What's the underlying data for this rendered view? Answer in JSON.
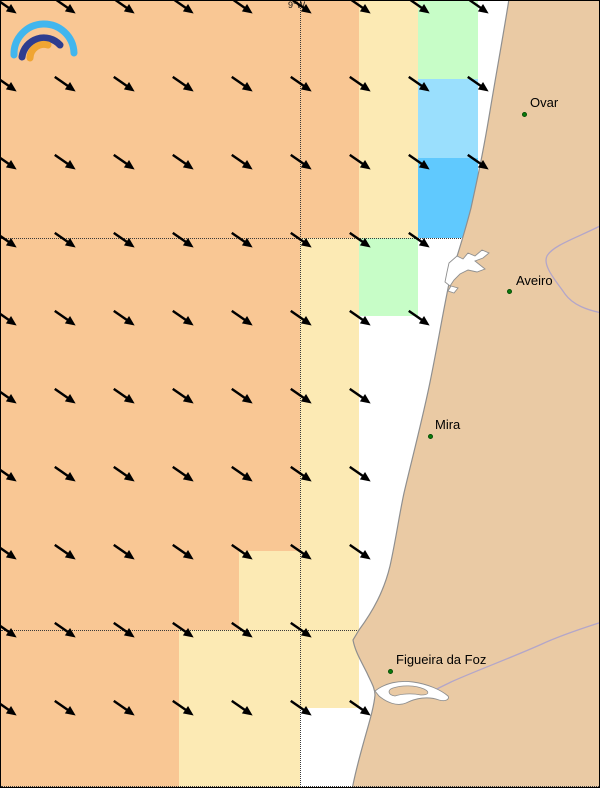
{
  "map": {
    "meridian_label": "9°W",
    "palette": {
      "sea": "#FFFFFF",
      "orange": "#F9C794",
      "yellow": "#FCEAB4",
      "green": "#C7FDC7",
      "lightBlue": "#9ADFFD",
      "brightBlue": "#60C9FE",
      "land": "#EACAA4",
      "coastline": "#8F8F8F",
      "river": "#B3A6C9",
      "water_body": "#FFFFFF",
      "gridline": "#3A3A3A",
      "arrow": "#000000",
      "city_dot": "#0B7D0B",
      "city_text": "#000000",
      "logo_outer_arc": "#41B6EE",
      "logo_middle_arc": "#2E3D8F",
      "logo_inner_arc": "#F0A532"
    },
    "cells": [
      {
        "x": 0,
        "y": 0,
        "w": 358,
        "h": 237,
        "c": "orange"
      },
      {
        "x": 358,
        "y": 0,
        "w": 59,
        "h": 237,
        "c": "yellow"
      },
      {
        "x": 417,
        "y": 0,
        "w": 60,
        "h": 78,
        "c": "green"
      },
      {
        "x": 417,
        "y": 78,
        "w": 60,
        "h": 79,
        "c": "lightBlue"
      },
      {
        "x": 417,
        "y": 157,
        "w": 60,
        "h": 80,
        "c": "brightBlue"
      },
      {
        "x": 0,
        "y": 237,
        "w": 299,
        "h": 313,
        "c": "orange"
      },
      {
        "x": 0,
        "y": 550,
        "w": 238,
        "h": 79,
        "c": "orange"
      },
      {
        "x": 238,
        "y": 550,
        "w": 61,
        "h": 79,
        "c": "yellow"
      },
      {
        "x": 299,
        "y": 237,
        "w": 59,
        "h": 392,
        "c": "yellow"
      },
      {
        "x": 358,
        "y": 237,
        "w": 59,
        "h": 78,
        "c": "green"
      },
      {
        "x": 0,
        "y": 629,
        "w": 178,
        "h": 159,
        "c": "orange"
      },
      {
        "x": 178,
        "y": 629,
        "w": 121,
        "h": 159,
        "c": "yellow"
      },
      {
        "x": 299,
        "y": 629,
        "w": 59,
        "h": 78,
        "c": "yellow"
      }
    ],
    "arrows": {
      "direction": "to-southeast",
      "angle_deg": 35,
      "col_xs": [
        4,
        63,
        122,
        181,
        240,
        299,
        358,
        417,
        476
      ],
      "rows": [
        {
          "y": 3,
          "n": 9
        },
        {
          "y": 81,
          "n": 9
        },
        {
          "y": 159,
          "n": 9
        },
        {
          "y": 237,
          "n": 8
        },
        {
          "y": 315,
          "n": 8
        },
        {
          "y": 393,
          "n": 7
        },
        {
          "y": 471,
          "n": 7
        },
        {
          "y": 549,
          "n": 7
        },
        {
          "y": 627,
          "n": 6
        },
        {
          "y": 705,
          "n": 7
        }
      ]
    },
    "gridlines": {
      "meridian_x": 299,
      "parallels_y": [
        237,
        629,
        785
      ]
    },
    "cities": [
      {
        "name": "Ovar",
        "dot_x": 523,
        "dot_y": 113,
        "label_x": 529,
        "label_y": 94
      },
      {
        "name": "Aveiro",
        "dot_x": 508,
        "dot_y": 290,
        "label_x": 515,
        "label_y": 272
      },
      {
        "name": "Mira",
        "dot_x": 429,
        "dot_y": 435,
        "label_x": 434,
        "label_y": 416
      },
      {
        "name": "Figueira da Foz",
        "dot_x": 389,
        "dot_y": 670,
        "label_x": 395,
        "label_y": 651
      }
    ],
    "logo_icon": "rainbow-arcs-logo"
  }
}
